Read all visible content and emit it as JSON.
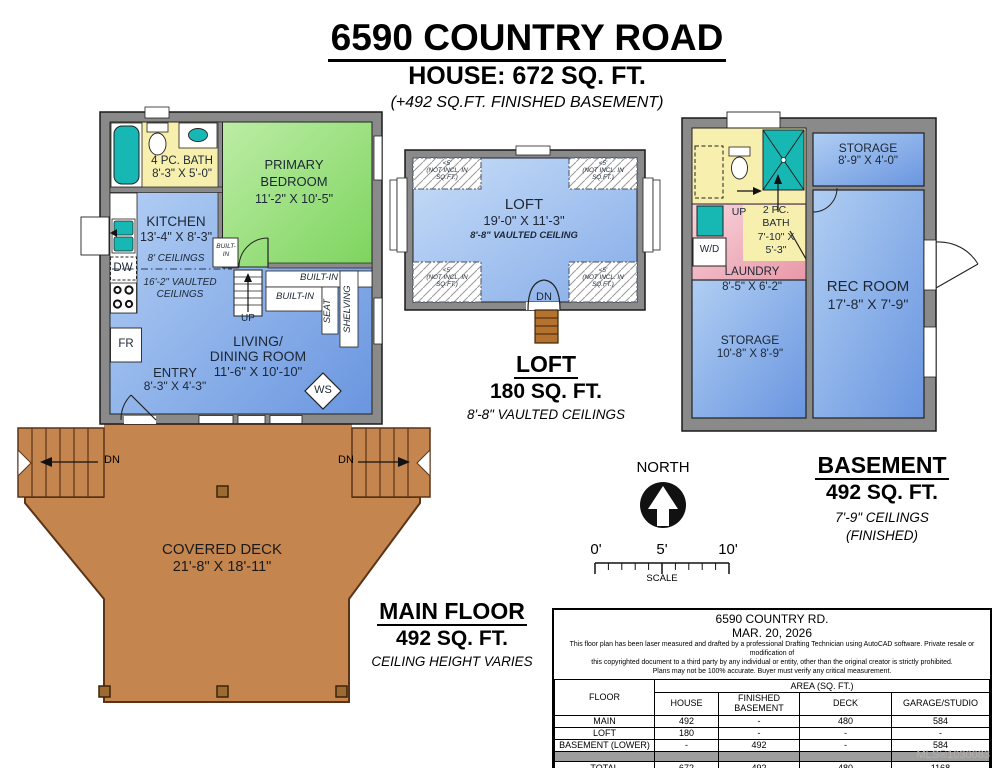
{
  "header": {
    "title": "6590 COUNTRY ROAD",
    "subtitle": "HOUSE: 672 SQ. FT.",
    "note": "(+492 SQ.FT. FINISHED BASEMENT)"
  },
  "main_floor": {
    "bath": {
      "name": "4 PC. BATH",
      "dims": "8'-3\" X 5'-0\""
    },
    "bedroom": {
      "line1": "PRIMARY",
      "line2": "BEDROOM",
      "dims": "11'-2\" X 10'-5\""
    },
    "kitchen": {
      "name": "KITCHEN",
      "dims": "13'-4\" X 8'-3\"",
      "ceiling": "8' CEILINGS",
      "vaulted1": "16'-2\" VAULTED",
      "vaulted2": "CEILINGS"
    },
    "living": {
      "line1": "LIVING/",
      "line2": "DINING ROOM",
      "dims": "11'-6\" X 10'-10\""
    },
    "entry": {
      "name": "ENTRY",
      "dims": "8'-3\" X 4'-3\""
    },
    "labels": {
      "dw": "DW",
      "fr": "FR",
      "ws": "WS",
      "up": "UP",
      "built_in": "BUILT-IN",
      "built_in2": "BUILT-IN",
      "built_in_small": "BUILT-IN",
      "seat": "SEAT",
      "shelving": "SHELVING"
    },
    "title": "MAIN FLOOR",
    "area": "492 SQ. FT.",
    "ceiling_note": "CEILING HEIGHT VARIES"
  },
  "deck": {
    "name": "COVERED DECK",
    "dims": "21'-8\" X 18'-11\"",
    "dn_left": "DN",
    "dn_right": "DN"
  },
  "loft": {
    "room": "LOFT",
    "dims": "19'-0\" X 11'-3\"",
    "ceiling": "8'-8\" VAULTED CEILING",
    "corner_note1": "<5'",
    "corner_note2": "(NOT INCL. IN",
    "corner_note3": "SQ.FT.)",
    "dn": "DN",
    "title": "LOFT",
    "area": "180 SQ. FT.",
    "ceiling_note": "8'-8\" VAULTED CEILINGS"
  },
  "basement": {
    "storage_top": {
      "name": "STORAGE",
      "dims": "8'-9\" X 4'-0\""
    },
    "bath": {
      "line1": "2 PC.",
      "line2": "BATH",
      "line3": "7'-10\" X",
      "line4": "5'-3\""
    },
    "laundry": {
      "name": "LAUNDRY",
      "dims": "8'-5\" X 6'-2\""
    },
    "storage_bottom": {
      "name": "STORAGE",
      "dims": "10'-8\" X 8'-9\""
    },
    "rec": {
      "name": "REC ROOM",
      "dims": "17'-8\" X 7'-9\""
    },
    "labels": {
      "up": "UP",
      "wd": "W/D"
    },
    "title": "BASEMENT",
    "area": "492 SQ. FT.",
    "ceiling_note": "7'-9\" CEILINGS",
    "finished": "(FINISHED)"
  },
  "compass": {
    "label": "NORTH"
  },
  "scale": {
    "t0": "0'",
    "t5": "5'",
    "t10": "10'",
    "label": "SCALE"
  },
  "info_table": {
    "address": "6590 COUNTRY RD.",
    "date": "MAR. 20, 2026",
    "disclaimer1": "This floor plan has been laser measured and drafted by a professional Drafting Technician using AutoCAD software. Private resale or modification of",
    "disclaimer2": "this copyrighted document to a third party by any individual or entity, other than the original creator is strictly prohibited.",
    "disclaimer3": "Plans may not be 100% accurate.  Buyer must verify any critical measurement.",
    "area_header": "AREA (SQ. FT.)",
    "col_floor": "FLOOR",
    "columns": [
      "HOUSE",
      "FINISHED BASEMENT",
      "DECK",
      "GARAGE/STUDIO"
    ],
    "rows": [
      {
        "floor": "MAIN",
        "house": "492",
        "finished_basement": "-",
        "deck": "480",
        "garage_studio": "584"
      },
      {
        "floor": "LOFT",
        "house": "180",
        "finished_basement": "-",
        "deck": "-",
        "garage_studio": "-"
      },
      {
        "floor": "BASEMENT (LOWER)",
        "house": "-",
        "finished_basement": "492",
        "deck": "-",
        "garage_studio": "584"
      }
    ],
    "total": {
      "floor": "TOTAL",
      "house": "672",
      "finished_basement": "492",
      "deck": "480",
      "garage_studio": "1168"
    }
  },
  "watermark": "MLS®1030083",
  "colors": {
    "wall_gray": "#8a8a8a",
    "room_blue_light": "#b7d3f5",
    "room_blue_dark": "#6a96e0",
    "bedroom_green": "#8fd96e",
    "bath_yellow": "#f7efad",
    "laundry_pink": "#efb6c2",
    "deck_brown": "#c5854e",
    "deck_border": "#5c3317",
    "fixture_teal": "#17b8b4"
  }
}
